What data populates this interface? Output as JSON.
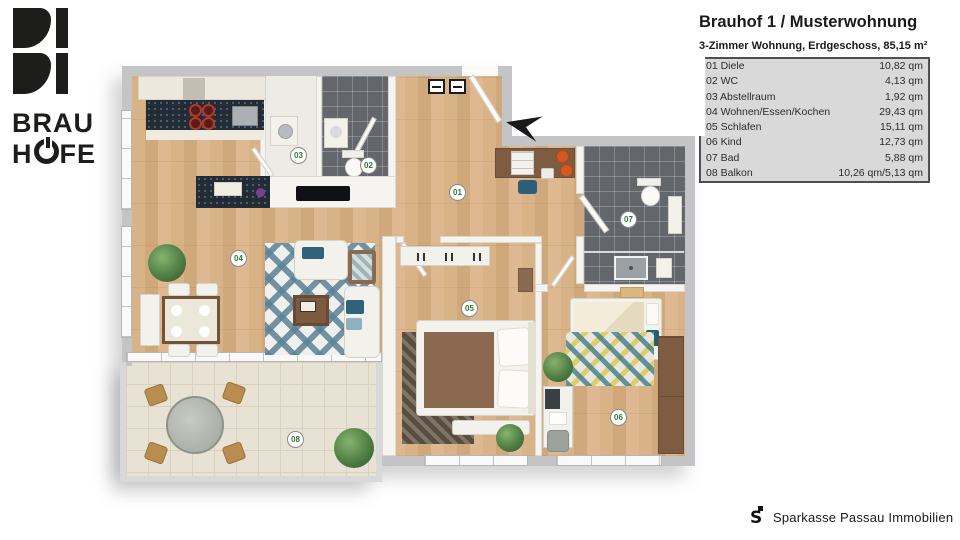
{
  "brand": {
    "line1": "BRAU",
    "line2_pre": "H",
    "line2_post": "FE"
  },
  "header": {
    "title": "Brauhof 1 / Musterwohnung",
    "subtitle": "3-Zimmer Wohnung, Erdgeschoss, 85,15 m²"
  },
  "legend": {
    "rows": [
      {
        "name": "01 Diele",
        "area": "10,82 qm"
      },
      {
        "name": "02 WC",
        "area": "4,13 qm"
      },
      {
        "name": "03 Abstellraum",
        "area": "1,92 qm"
      },
      {
        "name": "04 Wohnen/Essen/Kochen",
        "area": "29,43 qm"
      },
      {
        "name": "05 Schlafen",
        "area": "15,11 qm"
      },
      {
        "name": "06 Kind",
        "area": "12,73 qm"
      },
      {
        "name": "07 Bad",
        "area": "5,88 qm"
      },
      {
        "name": "08 Balkon",
        "area": "10,26 qm/5,13 qm"
      }
    ]
  },
  "plan": {
    "labels": [
      "01",
      "02",
      "03",
      "04",
      "05",
      "06",
      "07",
      "08"
    ]
  },
  "footer": {
    "company": "Sparkasse Passau Immobilien"
  },
  "colors": {
    "brand_black": "#1d1d1b",
    "label_green": "#2e7d32",
    "wall_gray": "#c4c4c7",
    "wood_floor": "#d5ae83",
    "dark_tile": "#63676b",
    "balcony_tile": "#e8e2d4",
    "accent_orange": "#d2591f",
    "accent_teal": "#2f6379",
    "legend_bg": "#d9d9d9"
  }
}
